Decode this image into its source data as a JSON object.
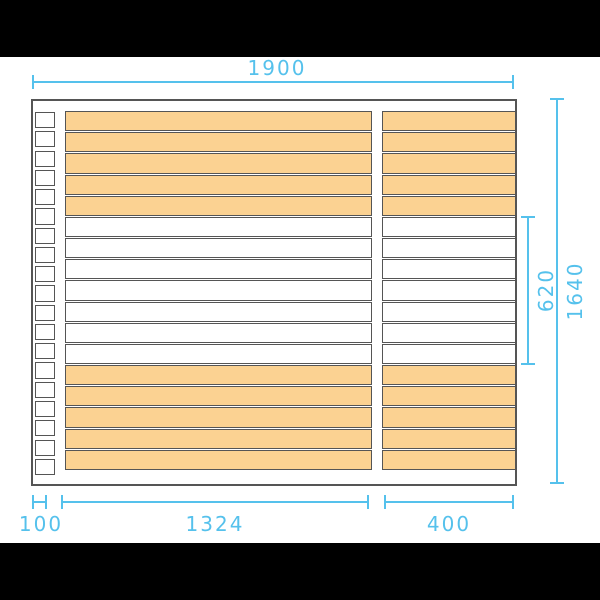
{
  "dims": {
    "top": "1900",
    "right_outer": "1640",
    "right_inner": "620",
    "bottom_left": "100",
    "bottom_mid": "1324",
    "bottom_right": "400"
  },
  "colors": {
    "dimension_blue": "#55C1EC",
    "board_orange": "#FBD292",
    "board_stroke": "#555555",
    "drawing_background": "#FFFFFF",
    "letterbox_black": "#000000"
  },
  "panel": {
    "left_post_cells": 19,
    "board_rows": 17,
    "board_pattern": [
      "O",
      "O",
      "O",
      "O",
      "O",
      "W",
      "W",
      "W",
      "W",
      "W",
      "W",
      "W",
      "O",
      "O",
      "O",
      "O",
      "O"
    ]
  }
}
